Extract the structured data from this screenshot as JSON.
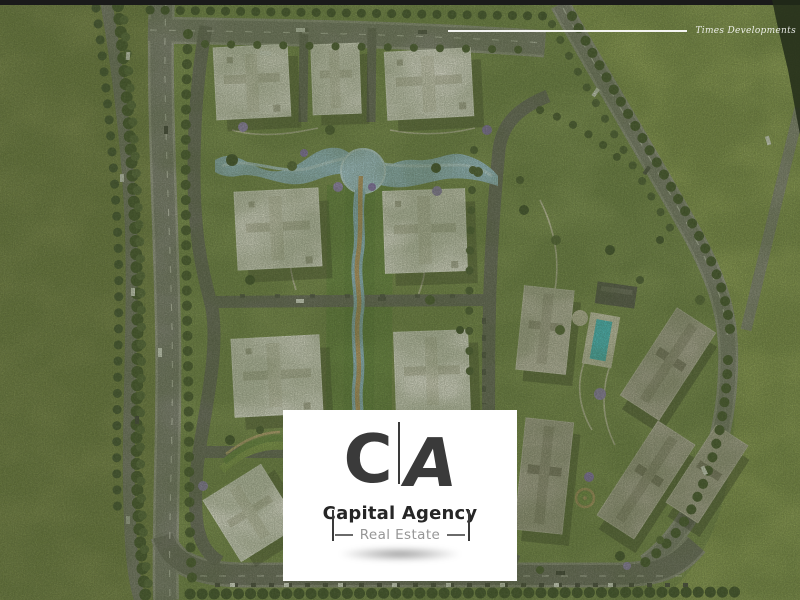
{
  "watermark": {
    "developer_name": "Times Developments"
  },
  "logo_card": {
    "monogram_left": "C",
    "monogram_right": "A",
    "agency_name": "Capital Agency",
    "tagline": "Real Estate"
  },
  "colors": {
    "logo_ink": "#3a3a3a",
    "tagline_gray": "#969696",
    "card_bg": "#ffffff",
    "watermark_white": "#ffffff",
    "grass_field_left": "#798549",
    "grass_field_right": "#8e9e54",
    "compound_lawn": "#7d8f4f",
    "water_canal": "#9cc2d4",
    "pond": "#a9cbdc",
    "pool": "#45c6d6",
    "road_asphalt": "#82817a",
    "internal_road": "#6b6a62",
    "building_white": "#e9e6dd",
    "building_taupe": "#b2ab9d",
    "walkway_tan": "#c09b67",
    "jacaranda_purple": "#9c86c6",
    "tree_green": "#43532c"
  }
}
